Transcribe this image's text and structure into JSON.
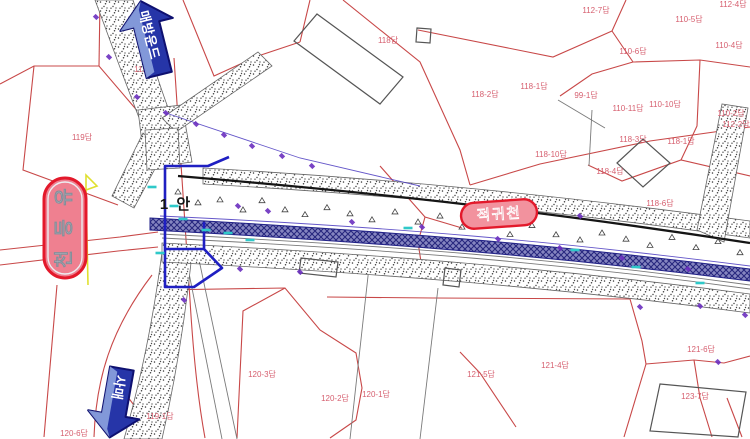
{
  "drawing": {
    "plan_label": "1 안",
    "badges": {
      "stream_left": "유등천",
      "stream_mid": "적귀천"
    },
    "arrows": {
      "north_label": "매방운드",
      "south_label": "사매"
    },
    "colors": {
      "parcel_line": "#c84848",
      "parcel_label": "#d65f6f",
      "water_strip": "#8585c0",
      "water_hatch": "#27277e",
      "levee_edge": "#666666",
      "plan_outline": "#1f1fc2",
      "badge_fill": "#ef8090",
      "badge_border": "#e3192b",
      "arrow_fill": "#2635a8",
      "arrow_bevel": "#93a9e2",
      "survey_tick": "#6a2fbf",
      "level_mark": "#2fc9c9",
      "benchmark": "#e8e833"
    },
    "parcels": [
      {
        "text": "112-7답",
        "x": 596,
        "y": 13
      },
      {
        "text": "112-4답",
        "x": 733,
        "y": 7
      },
      {
        "text": "110-5답",
        "x": 689,
        "y": 22
      },
      {
        "text": "110-4답",
        "x": 729,
        "y": 48
      },
      {
        "text": "110-6답",
        "x": 633,
        "y": 54
      },
      {
        "text": "99-1답",
        "x": 586,
        "y": 98
      },
      {
        "text": "110-11답",
        "x": 628,
        "y": 111
      },
      {
        "text": "110-10답",
        "x": 665,
        "y": 107
      },
      {
        "text": "110-2답",
        "x": 731,
        "y": 116
      },
      {
        "text": "112-2답",
        "x": 736,
        "y": 127
      },
      {
        "text": "118답",
        "x": 388,
        "y": 43
      },
      {
        "text": "118-2답",
        "x": 485,
        "y": 97
      },
      {
        "text": "118-1답",
        "x": 534,
        "y": 89
      },
      {
        "text": "119-12답",
        "x": 150,
        "y": 72
      },
      {
        "text": "119답",
        "x": 82,
        "y": 140
      },
      {
        "text": "118-10답",
        "x": 551,
        "y": 157
      },
      {
        "text": "118-3답",
        "x": 633,
        "y": 142
      },
      {
        "text": "118-1답",
        "x": 681,
        "y": 144
      },
      {
        "text": "118-4답",
        "x": 610,
        "y": 174
      },
      {
        "text": "118-6답",
        "x": 660,
        "y": 206
      },
      {
        "text": "120-3답",
        "x": 262,
        "y": 377
      },
      {
        "text": "120-2답",
        "x": 335,
        "y": 401
      },
      {
        "text": "120-1답",
        "x": 376,
        "y": 397
      },
      {
        "text": "121-5답",
        "x": 481,
        "y": 377
      },
      {
        "text": "121-4답",
        "x": 555,
        "y": 368
      },
      {
        "text": "121-6답",
        "x": 701,
        "y": 352
      },
      {
        "text": "123-7답",
        "x": 695,
        "y": 399
      },
      {
        "text": "119-1답",
        "x": 160,
        "y": 419
      },
      {
        "text": "120-6답",
        "x": 74,
        "y": 436
      }
    ]
  }
}
